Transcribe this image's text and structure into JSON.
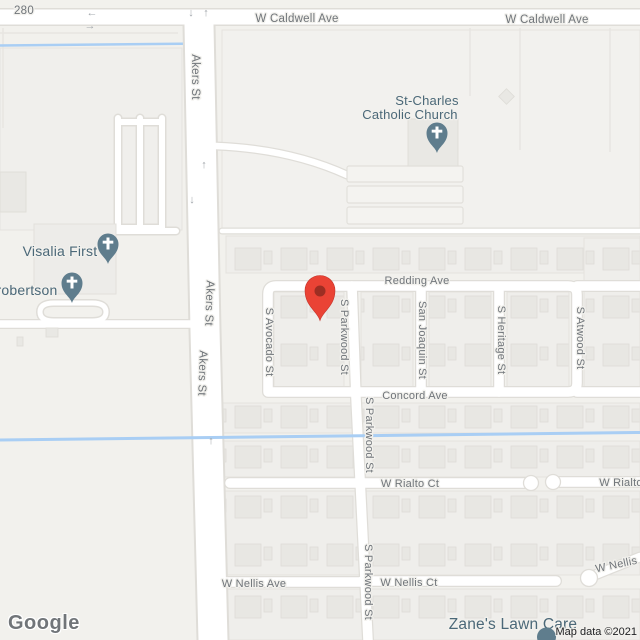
{
  "map": {
    "labels": {
      "route": "280",
      "caldwell": "W Caldwell Ave",
      "akers": "Akers St",
      "redding": "Redding Ave",
      "avocado": "S Avocado St",
      "parkwood": "S Parkwood St",
      "san_joaquin": "San Joaquin St",
      "heritage": "S Heritage St",
      "atwood": "S Atwood St",
      "concord": "Concord Ave",
      "rialto_ct": "W Rialto Ct",
      "rialto": "W Rialto",
      "nellis_ave": "W Nellis Ave",
      "nellis_ct": "W Nellis Ct",
      "nellis": "W Nellis",
      "watermark": "Google",
      "attribution": "Map data ©2021"
    },
    "pois": {
      "st_charles_line1": "St-Charles",
      "st_charles_line2": "Catholic Church",
      "visalia_first": "Visalia First",
      "robertson": "robertson",
      "zanes": "Zane's Lawn Care"
    },
    "icons": {
      "arrow_left": "←",
      "arrow_right": "→",
      "arrow_up": "↑",
      "arrow_down": "↓"
    },
    "colors": {
      "marker_red": "#ea4335",
      "marker_red_inner": "#8f2a20",
      "poi_pin": "#5f7d8d",
      "water": "#a9cef4",
      "road_fill": "#ffffff",
      "road_casing": "#dfddd8",
      "street_text": "#70757a",
      "poi_text": "#4b6878",
      "land": "#f2f1ed"
    }
  }
}
